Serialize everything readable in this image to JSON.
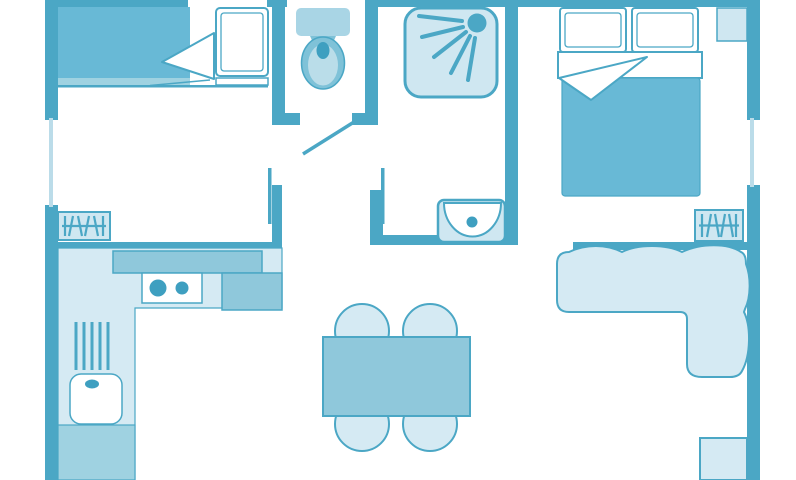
{
  "figure": {
    "type": "floor-plan",
    "description": "single-story holiday-home floor plan, top-down view, no text labels"
  },
  "palette": {
    "bg": "#FFFFFF",
    "wall": "#4BA7C5",
    "window": "#BBDCE9",
    "light": "#D5EAF3",
    "light2": "#CFE7F1",
    "medium": "#8FC8DB",
    "medium2": "#9FD2E1",
    "blanket": "#68B9D6",
    "tank": "#A9D5E5",
    "bowl_outer": "#7FC2D8",
    "bowl_inner": "#BADDE9",
    "accent": "#3E9FC0",
    "white": "#FFFFFF"
  },
  "rooms": [
    {
      "name": "bed-nook"
    },
    {
      "name": "toilet-room"
    },
    {
      "name": "shower-room"
    },
    {
      "name": "bedroom"
    },
    {
      "name": "kitchen"
    },
    {
      "name": "living-room"
    }
  ],
  "furniture": [
    "single-bed",
    "single-bed-pillow",
    "toilet",
    "shower-tray",
    "shower-head",
    "double-bed",
    "double-bed-pillows",
    "nightstand",
    "radiator-left",
    "radiator-right",
    "washbasin",
    "kitchen-counter",
    "worktop",
    "hob-two-burners",
    "dish-drainer",
    "kitchen-sink",
    "lower-cabinet",
    "dining-table",
    "dining-chairs",
    "corner-sofa",
    "corner-cabinet"
  ]
}
